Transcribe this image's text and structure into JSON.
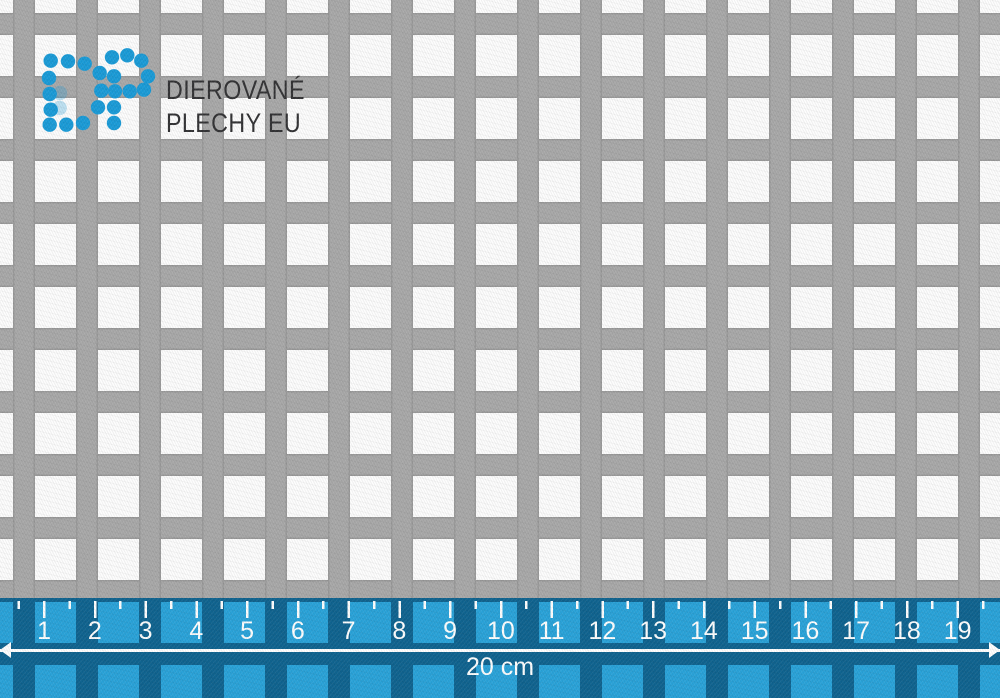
{
  "theme": {
    "metal_gray": "#a9a9a9",
    "hole_white": "#fdfdfd",
    "logo_blue": "#1b9cd8",
    "logo_text_color": "#333335",
    "ruler_dark_blue": "#106490",
    "ruler_light_blue": "#2aa3d9",
    "ruler_mark_white": "#ffffff"
  },
  "logo": {
    "line1": "DIEROVANÉ",
    "line2": "PLECHY EU"
  },
  "ruler": {
    "tick_labels": [
      "1",
      "2",
      "3",
      "4",
      "5",
      "6",
      "7",
      "8",
      "9",
      "10",
      "11",
      "12",
      "13",
      "14",
      "15",
      "16",
      "17",
      "18",
      "19"
    ],
    "length_label": "20 cm"
  }
}
